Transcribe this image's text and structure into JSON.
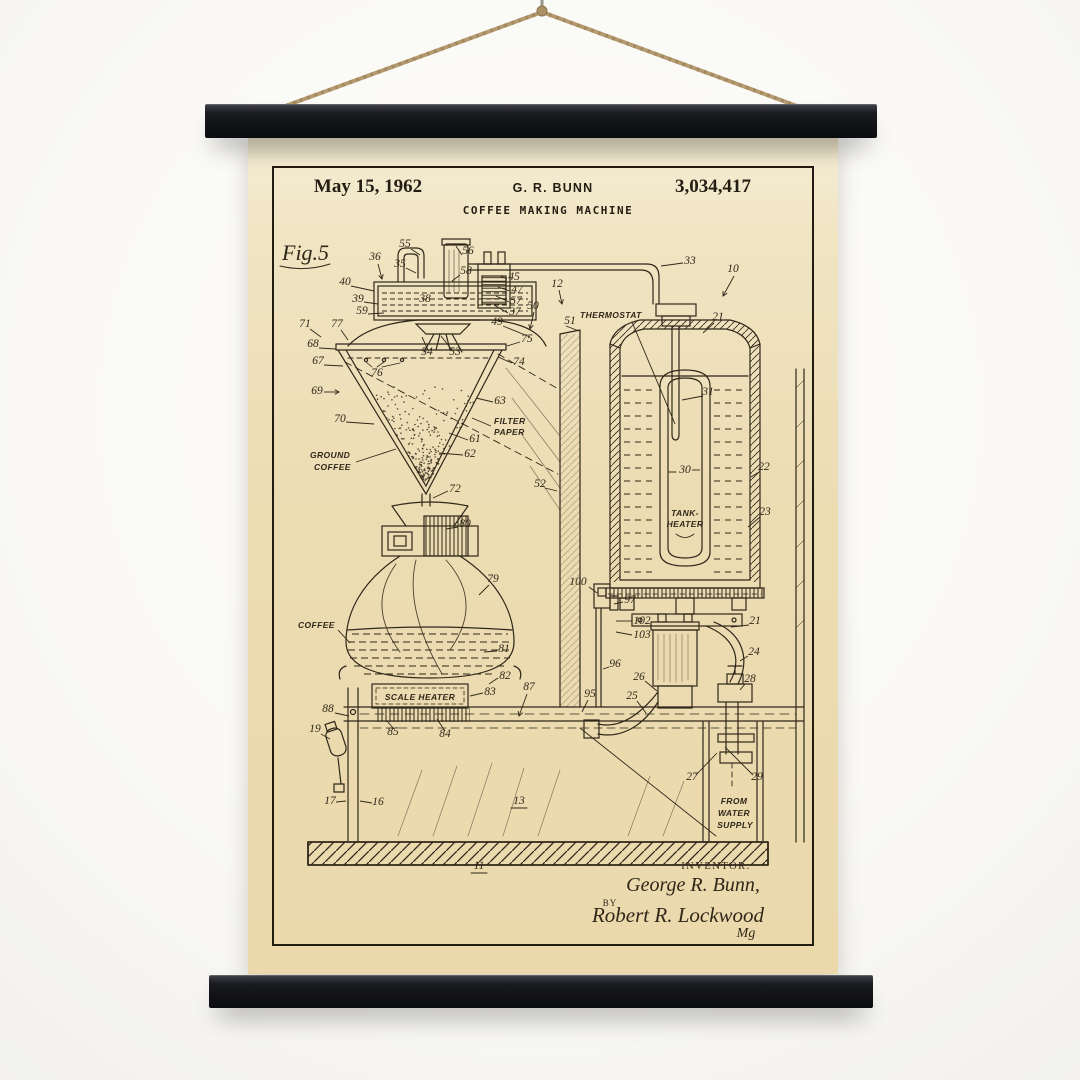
{
  "scene": {
    "wall_color": "#faf9f6",
    "rope_color": "#b49a6e",
    "bar_color": "#17181b",
    "paper_color": "#ecdcb2",
    "ink_color": "#2f2719"
  },
  "poster": {
    "header": {
      "date": "May 15, 1962",
      "inventor": "G. R. BUNN",
      "patent_number": "3,034,417",
      "title": "COFFEE MAKING MACHINE"
    },
    "drawing": {
      "figure_label": "Fig.5",
      "part_numbers": [
        {
          "n": "36",
          "x": 127,
          "y": 124,
          "leader": [
            130,
            128,
            134,
            143
          ],
          "arrow": true
        },
        {
          "n": "55",
          "x": 157,
          "y": 111,
          "leader": [
            163,
            113,
            172,
            119
          ]
        },
        {
          "n": "35",
          "x": 152,
          "y": 131,
          "leader": [
            158,
            132,
            168,
            137
          ]
        },
        {
          "n": "56",
          "x": 220,
          "y": 118,
          "leader": [
            214,
            119,
            208,
            110
          ]
        },
        {
          "n": "58",
          "x": 218,
          "y": 138,
          "leader": [
            212,
            139,
            204,
            145
          ]
        },
        {
          "n": "40",
          "x": 97,
          "y": 149,
          "leader": [
            103,
            150,
            126,
            155
          ]
        },
        {
          "n": "39",
          "x": 110,
          "y": 166,
          "leader": [
            116,
            166,
            130,
            168
          ]
        },
        {
          "n": "59",
          "x": 114,
          "y": 178,
          "leader": [
            120,
            178,
            136,
            177
          ]
        },
        {
          "n": "38",
          "x": 177,
          "y": 166
        },
        {
          "n": "45",
          "x": 266,
          "y": 144,
          "leader": [
            259,
            143,
            252,
            140
          ]
        },
        {
          "n": "47",
          "x": 269,
          "y": 157,
          "leader": [
            262,
            155,
            250,
            151
          ]
        },
        {
          "n": "57",
          "x": 268,
          "y": 168,
          "leader": [
            261,
            166,
            248,
            160
          ]
        },
        {
          "n": "37",
          "x": 267,
          "y": 179,
          "leader": [
            260,
            177,
            246,
            169
          ]
        },
        {
          "n": "49",
          "x": 249,
          "y": 189,
          "leader": [
            255,
            190,
            282,
            201
          ]
        },
        {
          "n": "50",
          "x": 285,
          "y": 173,
          "leader": [
            286,
            176,
            282,
            193
          ],
          "arrow": true
        },
        {
          "n": "12",
          "x": 309,
          "y": 151,
          "leader": [
            311,
            154,
            314,
            168
          ],
          "arrow": true
        },
        {
          "n": "51",
          "x": 322,
          "y": 188,
          "leader": [
            318,
            190,
            331,
            195
          ]
        },
        {
          "n": "33",
          "x": 442,
          "y": 128,
          "leader": [
            435,
            127,
            413,
            130
          ]
        },
        {
          "n": "10",
          "x": 485,
          "y": 136,
          "leader": [
            486,
            140,
            475,
            160
          ],
          "arrow": true
        },
        {
          "n": "21",
          "x": 470,
          "y": 184,
          "leader": [
            466,
            187,
            455,
            197
          ]
        },
        {
          "n": "31",
          "x": 460,
          "y": 259,
          "leader": [
            455,
            260,
            434,
            264
          ]
        },
        {
          "n": "30",
          "x": 437,
          "y": 337,
          "leader": [
            444,
            334,
            452,
            334
          ]
        },
        {
          "n": "22",
          "x": 516,
          "y": 334,
          "leader": [
            511,
            336,
            503,
            341
          ]
        },
        {
          "n": "23",
          "x": 517,
          "y": 379,
          "leader": [
            512,
            381,
            500,
            391
          ]
        },
        {
          "n": "100",
          "x": 330,
          "y": 449,
          "leader": [
            341,
            451,
            349,
            457
          ]
        },
        {
          "n": "97",
          "x": 382,
          "y": 467,
          "leader": [
            375,
            466,
            366,
            468
          ]
        },
        {
          "n": "102",
          "x": 394,
          "y": 488,
          "leader": [
            384,
            485,
            368,
            485
          ]
        },
        {
          "n": "103",
          "x": 394,
          "y": 502,
          "leader": [
            384,
            499,
            368,
            496
          ]
        },
        {
          "n": "96",
          "x": 367,
          "y": 531,
          "leader": [
            361,
            531,
            355,
            533
          ]
        },
        {
          "n": "26",
          "x": 391,
          "y": 544,
          "leader": [
            397,
            545,
            409,
            555
          ]
        },
        {
          "n": "25",
          "x": 384,
          "y": 563,
          "leader": [
            389,
            565,
            398,
            577
          ]
        },
        {
          "n": "24",
          "x": 506,
          "y": 519,
          "leader": [
            500,
            520,
            492,
            525
          ]
        },
        {
          "n": "28",
          "x": 502,
          "y": 546,
          "leader": [
            497,
            548,
            492,
            554
          ]
        },
        {
          "n": "21",
          "x": 507,
          "y": 488,
          "leader": [
            501,
            489,
            483,
            491
          ]
        },
        {
          "n": "27",
          "x": 444,
          "y": 644,
          "leader": [
            448,
            639,
            469,
            617
          ]
        },
        {
          "n": "29",
          "x": 509,
          "y": 644,
          "leader": [
            505,
            639,
            477,
            611
          ]
        },
        {
          "n": "71",
          "x": 57,
          "y": 191,
          "leader": [
            62,
            193,
            73,
            201
          ]
        },
        {
          "n": "77",
          "x": 89,
          "y": 191,
          "leader": [
            93,
            194,
            100,
            204
          ]
        },
        {
          "n": "68",
          "x": 65,
          "y": 211,
          "leader": [
            71,
            212,
            88,
            213
          ]
        },
        {
          "n": "67",
          "x": 70,
          "y": 228,
          "leader": [
            76,
            229,
            95,
            230
          ]
        },
        {
          "n": "76",
          "x": 129,
          "y": 240
        },
        {
          "n": "54",
          "x": 179,
          "y": 219,
          "leader": [
            180,
            214,
            174,
            201
          ]
        },
        {
          "n": "53",
          "x": 207,
          "y": 219,
          "leader": [
            204,
            214,
            193,
            200
          ]
        },
        {
          "n": "75",
          "x": 279,
          "y": 206,
          "leader": [
            272,
            206,
            259,
            210
          ]
        },
        {
          "n": "74",
          "x": 271,
          "y": 229,
          "leader": [
            264,
            227,
            250,
            221
          ]
        },
        {
          "n": "69",
          "x": 69,
          "y": 258,
          "leader": [
            76,
            256,
            91,
            256
          ],
          "arrow": true
        },
        {
          "n": "70",
          "x": 92,
          "y": 286,
          "leader": [
            98,
            286,
            126,
            288
          ]
        },
        {
          "n": "63",
          "x": 252,
          "y": 268,
          "leader": [
            245,
            266,
            228,
            262
          ]
        },
        {
          "n": "61",
          "x": 227,
          "y": 306,
          "leader": [
            220,
            304,
            201,
            297
          ]
        },
        {
          "n": "62",
          "x": 222,
          "y": 321,
          "leader": [
            215,
            319,
            191,
            317
          ]
        },
        {
          "n": "72",
          "x": 207,
          "y": 356,
          "leader": [
            200,
            355,
            185,
            362
          ]
        },
        {
          "n": "52",
          "x": 292,
          "y": 351,
          "leader": [
            297,
            352,
            309,
            355
          ]
        },
        {
          "n": "80",
          "x": 217,
          "y": 391,
          "leader": [
            210,
            391,
            198,
            393
          ]
        },
        {
          "n": "79",
          "x": 245,
          "y": 446,
          "leader": [
            241,
            449,
            231,
            459
          ]
        },
        {
          "n": "81",
          "x": 256,
          "y": 516,
          "leader": [
            249,
            515,
            236,
            516
          ]
        },
        {
          "n": "82",
          "x": 257,
          "y": 543,
          "leader": [
            250,
            542,
            241,
            548
          ]
        },
        {
          "n": "83",
          "x": 242,
          "y": 559,
          "leader": [
            235,
            557,
            222,
            560
          ]
        },
        {
          "n": "88",
          "x": 80,
          "y": 576,
          "leader": [
            87,
            577,
            101,
            580
          ]
        },
        {
          "n": "85",
          "x": 145,
          "y": 599,
          "leader": [
            146,
            593,
            139,
            585
          ]
        },
        {
          "n": "84",
          "x": 197,
          "y": 601,
          "leader": [
            197,
            595,
            189,
            583
          ]
        },
        {
          "n": "87",
          "x": 281,
          "y": 554,
          "leader": [
            279,
            558,
            271,
            580
          ],
          "arrow": true
        },
        {
          "n": "95",
          "x": 342,
          "y": 561,
          "leader": [
            340,
            564,
            334,
            576
          ]
        },
        {
          "n": "19",
          "x": 67,
          "y": 596,
          "leader": [
            73,
            598,
            82,
            603
          ]
        },
        {
          "n": "17",
          "x": 82,
          "y": 668,
          "leader": [
            88,
            666,
            98,
            665
          ]
        },
        {
          "n": "16",
          "x": 130,
          "y": 669,
          "leader": [
            124,
            667,
            112,
            665
          ]
        },
        {
          "n": "13",
          "x": 271,
          "y": 668
        },
        {
          "n": "11",
          "x": 231,
          "y": 733
        }
      ],
      "text_labels": [
        {
          "text": "Fig.5",
          "x": 34,
          "y": 124,
          "cls": "fig",
          "anchor": "start"
        },
        {
          "text": "THERMOSTAT",
          "x": 332,
          "y": 182,
          "cls": "lbl",
          "anchor": "start",
          "leader": [
            384,
            186,
            427,
            288
          ]
        },
        {
          "text": "TANK-",
          "x": 437,
          "y": 380,
          "cls": "lbl",
          "anchor": "middle"
        },
        {
          "text": "HEATER",
          "x": 437,
          "y": 391,
          "cls": "lbl",
          "anchor": "middle"
        },
        {
          "text": "FILTER",
          "x": 246,
          "y": 288,
          "cls": "lbl",
          "anchor": "start",
          "leader": [
            243,
            290,
            224,
            282
          ]
        },
        {
          "text": "PAPER",
          "x": 246,
          "y": 299,
          "cls": "lbl",
          "anchor": "start"
        },
        {
          "text": "GROUND",
          "x": 62,
          "y": 322,
          "cls": "lbl",
          "anchor": "start"
        },
        {
          "text": "COFFEE",
          "x": 66,
          "y": 334,
          "cls": "lbl",
          "anchor": "start",
          "leader": [
            108,
            326,
            148,
            313
          ]
        },
        {
          "text": "COFFEE",
          "x": 50,
          "y": 492,
          "cls": "lbl",
          "anchor": "start",
          "leader": [
            90,
            494,
            102,
            507
          ]
        },
        {
          "text": "SCALE HEATER",
          "x": 172,
          "y": 564,
          "cls": "lbl",
          "anchor": "middle"
        },
        {
          "text": "FROM",
          "x": 486,
          "y": 668,
          "cls": "lbl",
          "anchor": "middle"
        },
        {
          "text": "WATER",
          "x": 486,
          "y": 680,
          "cls": "lbl",
          "anchor": "middle"
        },
        {
          "text": "SUPPLY",
          "x": 487,
          "y": 692,
          "cls": "lbl",
          "anchor": "middle"
        },
        {
          "text": "INVENTOR.",
          "x": 468,
          "y": 733,
          "cls": "cap",
          "anchor": "middle"
        },
        {
          "text": "George R. Bunn,",
          "x": 445,
          "y": 755,
          "cls": "script",
          "anchor": "middle"
        },
        {
          "text": "BY",
          "x": 362,
          "y": 770,
          "cls": "cap2",
          "anchor": "middle"
        },
        {
          "text": "Robert R. Lockwood",
          "x": 430,
          "y": 786,
          "cls": "script2",
          "anchor": "middle"
        },
        {
          "text": "Mg",
          "x": 498,
          "y": 801,
          "cls": "script3",
          "anchor": "middle"
        }
      ]
    }
  }
}
